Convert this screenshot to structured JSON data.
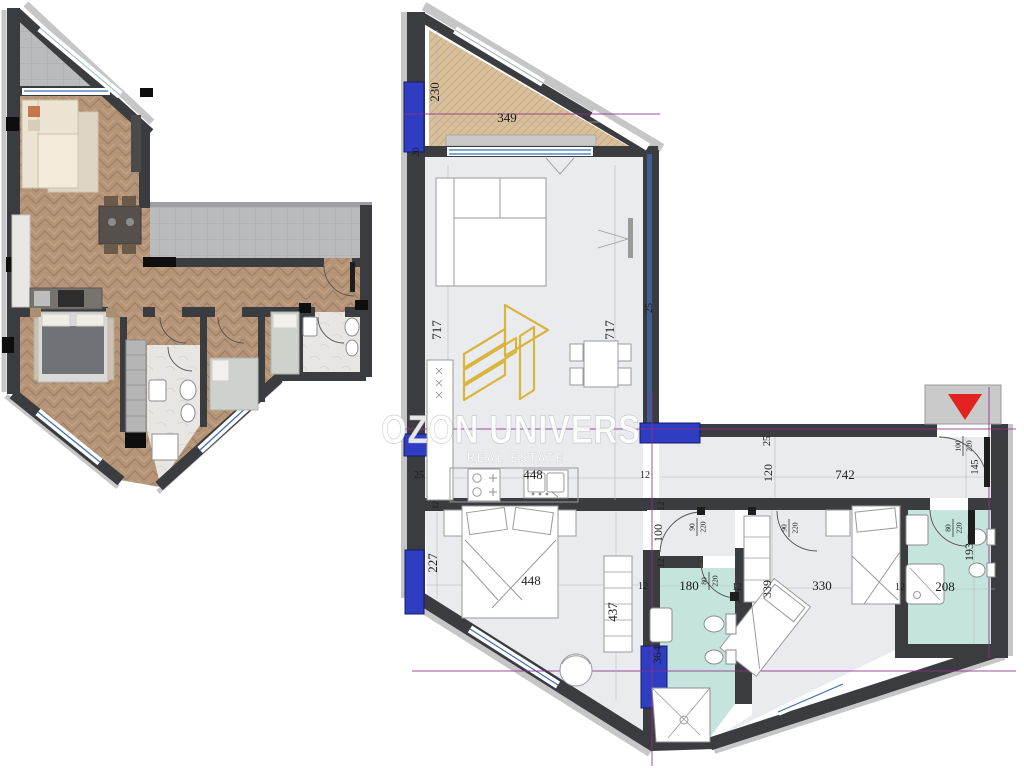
{
  "watermark": {
    "brand": "OZON UNIVERS",
    "tagline": "REAL ESTATE"
  },
  "brand": {
    "logo_icon": "gold-buildings-logo",
    "entrance_icon": "entrance-arrow"
  },
  "colors": {
    "wall": "#3b3c40",
    "floor": "#e9ebee",
    "wood": "#b69478",
    "terrace_hatch": "#d9c09c",
    "tile_gray": "#b9bbbe",
    "bathroom_teal": "#c5e4de",
    "window_marker_blue": "#2e3dc2",
    "logo_gold": "#d9b53c",
    "guide_magenta": "#8e2f8e",
    "entrance_arrow_red": "#e32222"
  },
  "dims": {
    "terrace_height": "230",
    "terrace_width": "349",
    "terrace_parapet": "20",
    "living_left": "717",
    "living_right": "717",
    "living_wall_right": "25",
    "kitchen_wall_left": "25",
    "kitchen_width": "448",
    "kitchen_wall_right": "12",
    "kitchen_wall_thickness": "12",
    "corridor_wall": "25",
    "corridor_height": "120",
    "corridor_width": "742",
    "entry_clearance": "145",
    "bedroom1_side": "227",
    "bedroom1_width": "448",
    "bedroom1_depth": "437",
    "hall_wall_top": "12",
    "hall_width": "100",
    "hall_wall_bottom": "12",
    "bath1_wall_left": "12",
    "bath1_width": "180",
    "bath1_wall_right": "12",
    "bath1_length": "364",
    "bedroom2_side": "339",
    "bedroom2_width": "330",
    "bedroom2_wall": "12",
    "bath2_width": "208",
    "bath2_length": "193"
  },
  "doors": {
    "hall_left": {
      "w": "90",
      "h": "220"
    },
    "hall_right": {
      "w": "90",
      "h": "220"
    },
    "bath1": {
      "w": "80",
      "h": "220"
    },
    "bath2": {
      "w": "80",
      "h": "220"
    },
    "entry": {
      "w": "100",
      "h": "220"
    }
  }
}
